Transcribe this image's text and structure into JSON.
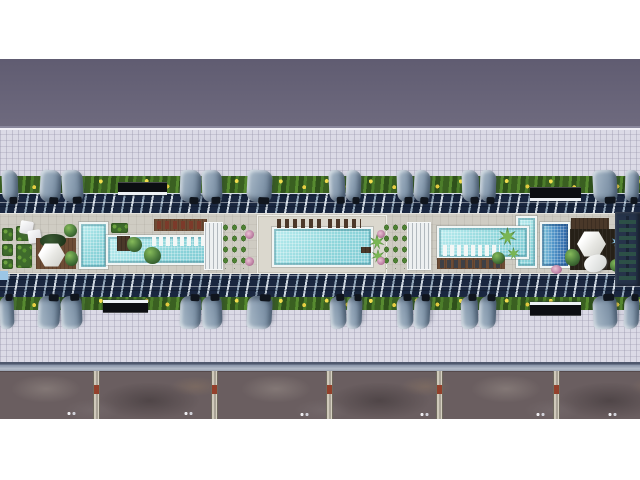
{
  "meta": {
    "kind": "aerial-architectural-render",
    "subject": "top-down 3D rendering of a long residential building rooftop amenity courtyard with three swimming pool zones, landscaping, shade canopies, tiled plazas and a lower service road",
    "visible_text": []
  },
  "palette": {
    "page_margin": "#ffffff",
    "upper_road": "#686479",
    "plaza_tile": "#dbdae6",
    "hedge_green": "#3c6323",
    "flower_yellow": "#f2dd4e",
    "glass_roof_dark": "#1a2740",
    "glass_roof_frame": "#ccd6e0",
    "canopy_steel_blue": "#8da0b3",
    "deck_beige": "#cfccc3",
    "pool_turquoise": "#9fdde1",
    "pool_deep_blue": "#2c62a4",
    "wood_brown": "#6d4c35",
    "rocky_ground": "#6a5e60",
    "divider_concrete": "#cfc9ba",
    "marker_red": "#93402b",
    "facade_navy": "#26334a"
  },
  "scene": {
    "width": 640,
    "height": 480,
    "items": [
      {
        "n": "upper-road-band",
        "c": "band-dark",
        "x": 0,
        "y": 59,
        "w": 640,
        "h": 71
      },
      {
        "n": "plaza-top",
        "c": "plaza edge-top",
        "x": 0,
        "y": 130,
        "w": 640,
        "h": 47
      },
      {
        "n": "plaza-bottom",
        "c": "plaza",
        "x": 0,
        "y": 308,
        "w": 640,
        "h": 55
      },
      {
        "n": "curb-strip",
        "c": "curb",
        "x": 0,
        "y": 362,
        "w": 640,
        "h": 9
      },
      {
        "n": "service-road-rocky",
        "c": "rocky",
        "x": 0,
        "y": 371,
        "w": 640,
        "h": 48
      },
      {
        "n": "hedge-strip-top",
        "c": "hedge",
        "x": 0,
        "y": 176,
        "w": 640,
        "h": 18
      },
      {
        "n": "glass-roof-top",
        "c": "glass",
        "x": 0,
        "y": 193,
        "w": 640,
        "h": 22
      },
      {
        "n": "glass-roof-bottom",
        "c": "glass",
        "x": 0,
        "y": 273,
        "w": 640,
        "h": 26
      },
      {
        "n": "hedge-strip-bottom",
        "c": "hedge",
        "x": 0,
        "y": 297,
        "w": 640,
        "h": 13
      },
      {
        "n": "amenity-deck",
        "c": "deck",
        "x": 0,
        "y": 213,
        "w": 640,
        "h": 61
      },
      {
        "n": "road-divider-1",
        "c": "divider",
        "x": 93,
        "y": 371,
        "w": 7,
        "h": 48
      },
      {
        "n": "road-divider-2",
        "c": "divider",
        "x": 211,
        "y": 371,
        "w": 7,
        "h": 48
      },
      {
        "n": "road-divider-3",
        "c": "divider",
        "x": 326,
        "y": 371,
        "w": 7,
        "h": 48
      },
      {
        "n": "road-divider-4",
        "c": "divider",
        "x": 436,
        "y": 371,
        "w": 7,
        "h": 48
      },
      {
        "n": "road-divider-5",
        "c": "divider",
        "x": 553,
        "y": 371,
        "w": 7,
        "h": 48
      },
      {
        "n": "road-dots-1",
        "c": "dots",
        "x": 66,
        "y": 411,
        "w": 10,
        "h": 5
      },
      {
        "n": "road-dots-2",
        "c": "dots",
        "x": 183,
        "y": 411,
        "w": 10,
        "h": 5
      },
      {
        "n": "road-dots-3",
        "c": "dots",
        "x": 299,
        "y": 412,
        "w": 10,
        "h": 5
      },
      {
        "n": "road-dots-4",
        "c": "dots",
        "x": 419,
        "y": 412,
        "w": 10,
        "h": 5
      },
      {
        "n": "road-dots-5",
        "c": "dots",
        "x": 535,
        "y": 412,
        "w": 10,
        "h": 5
      },
      {
        "n": "road-dots-6",
        "c": "dots",
        "x": 607,
        "y": 412,
        "w": 10,
        "h": 5
      },
      {
        "n": "entry-canopy-top-1",
        "c": "ebar",
        "x": 118,
        "y": 182,
        "w": 49,
        "h": 13
      },
      {
        "n": "entry-canopy-top-2",
        "c": "ebar",
        "x": 530,
        "y": 187,
        "w": 51,
        "h": 14
      },
      {
        "n": "entry-canopy-bottom-1",
        "c": "ebar flip",
        "x": 103,
        "y": 300,
        "w": 45,
        "h": 13
      },
      {
        "n": "entry-canopy-bottom-2",
        "c": "ebar flip",
        "x": 530,
        "y": 302,
        "w": 51,
        "h": 14
      },
      {
        "n": "canopy-top-1",
        "c": "canopy",
        "x": 2,
        "y": 170,
        "w": 16,
        "h": 32,
        "r": -2
      },
      {
        "n": "canopy-top-2",
        "c": "canopy",
        "x": 40,
        "y": 170,
        "w": 21,
        "h": 32,
        "r": 3
      },
      {
        "n": "canopy-top-3",
        "c": "canopy",
        "x": 62,
        "y": 170,
        "w": 21,
        "h": 32,
        "r": -3
      },
      {
        "n": "canopy-top-4",
        "c": "canopy",
        "x": 180,
        "y": 170,
        "w": 21,
        "h": 32,
        "r": 2
      },
      {
        "n": "canopy-top-5",
        "c": "canopy",
        "x": 202,
        "y": 170,
        "w": 20,
        "h": 32,
        "r": -2
      },
      {
        "n": "canopy-top-6",
        "c": "canopy",
        "x": 247,
        "y": 170,
        "w": 25,
        "h": 32,
        "r": 3
      },
      {
        "n": "canopy-top-7",
        "c": "canopy",
        "x": 329,
        "y": 170,
        "w": 16,
        "h": 32,
        "r": -3
      },
      {
        "n": "canopy-top-8",
        "c": "canopy",
        "x": 346,
        "y": 170,
        "w": 15,
        "h": 32,
        "r": 2
      },
      {
        "n": "canopy-top-9",
        "c": "canopy",
        "x": 397,
        "y": 170,
        "w": 16,
        "h": 32,
        "r": -2
      },
      {
        "n": "canopy-top-10",
        "c": "canopy",
        "x": 414,
        "y": 170,
        "w": 16,
        "h": 32,
        "r": 3
      },
      {
        "n": "canopy-top-11",
        "c": "canopy",
        "x": 462,
        "y": 170,
        "w": 17,
        "h": 32,
        "r": -2
      },
      {
        "n": "canopy-top-12",
        "c": "canopy",
        "x": 480,
        "y": 170,
        "w": 16,
        "h": 32,
        "r": 2
      },
      {
        "n": "canopy-top-13",
        "c": "canopy",
        "x": 593,
        "y": 170,
        "w": 24,
        "h": 32,
        "r": -3
      },
      {
        "n": "canopy-top-14",
        "c": "canopy",
        "x": 625,
        "y": 170,
        "w": 14,
        "h": 32,
        "r": 2
      },
      {
        "n": "canopy-bottom-1",
        "c": "canopy flip",
        "x": 0,
        "y": 296,
        "w": 14,
        "h": 33,
        "r": 2
      },
      {
        "n": "canopy-bottom-2",
        "c": "canopy flip",
        "x": 38,
        "y": 296,
        "w": 22,
        "h": 33,
        "r": -3
      },
      {
        "n": "canopy-bottom-3",
        "c": "canopy flip",
        "x": 61,
        "y": 296,
        "w": 21,
        "h": 33,
        "r": 3
      },
      {
        "n": "canopy-bottom-4",
        "c": "canopy flip",
        "x": 180,
        "y": 296,
        "w": 21,
        "h": 33,
        "r": -2
      },
      {
        "n": "canopy-bottom-5",
        "c": "canopy flip",
        "x": 202,
        "y": 296,
        "w": 20,
        "h": 33,
        "r": 2
      },
      {
        "n": "canopy-bottom-6",
        "c": "canopy flip",
        "x": 247,
        "y": 296,
        "w": 25,
        "h": 33,
        "r": -3
      },
      {
        "n": "canopy-bottom-7",
        "c": "canopy flip",
        "x": 330,
        "y": 296,
        "w": 16,
        "h": 33,
        "r": 3
      },
      {
        "n": "canopy-bottom-8",
        "c": "canopy flip",
        "x": 347,
        "y": 296,
        "w": 15,
        "h": 33,
        "r": -2
      },
      {
        "n": "canopy-bottom-9",
        "c": "canopy flip",
        "x": 397,
        "y": 296,
        "w": 16,
        "h": 33,
        "r": 2
      },
      {
        "n": "canopy-bottom-10",
        "c": "canopy flip",
        "x": 414,
        "y": 296,
        "w": 16,
        "h": 33,
        "r": -3
      },
      {
        "n": "canopy-bottom-11",
        "c": "canopy flip",
        "x": 461,
        "y": 296,
        "w": 17,
        "h": 33,
        "r": 2
      },
      {
        "n": "canopy-bottom-12",
        "c": "canopy flip",
        "x": 479,
        "y": 296,
        "w": 17,
        "h": 33,
        "r": -2
      },
      {
        "n": "canopy-bottom-13",
        "c": "canopy flip",
        "x": 593,
        "y": 296,
        "w": 24,
        "h": 33,
        "r": 3
      },
      {
        "n": "canopy-bottom-14",
        "c": "canopy flip",
        "x": 624,
        "y": 296,
        "w": 15,
        "h": 33,
        "r": -2
      },
      {
        "n": "planter-west-1",
        "c": "hedge-box",
        "x": 2,
        "y": 228,
        "w": 11,
        "h": 13
      },
      {
        "n": "planter-west-2",
        "c": "hedge-box",
        "x": 2,
        "y": 244,
        "w": 11,
        "h": 12
      },
      {
        "n": "planter-west-3",
        "c": "hedge-box",
        "x": 2,
        "y": 259,
        "w": 11,
        "h": 10
      },
      {
        "n": "pool-equipment-box",
        "c": "rect",
        "x": 0,
        "y": 271,
        "w": 8,
        "h": 9,
        "bg": "#9cc6e6"
      },
      {
        "n": "planter-west-4",
        "c": "hedge-box",
        "x": 16,
        "y": 226,
        "w": 16,
        "h": 15
      },
      {
        "n": "planter-west-5",
        "c": "hedge-box",
        "x": 16,
        "y": 244,
        "w": 16,
        "h": 24
      },
      {
        "n": "umbrella-west-1",
        "c": "umbrella",
        "x": 20,
        "y": 221,
        "w": 13,
        "h": 13,
        "r": 10
      },
      {
        "n": "umbrella-west-2",
        "c": "umbrella",
        "x": 28,
        "y": 230,
        "w": 13,
        "h": 13,
        "r": -8
      },
      {
        "n": "wood-deck-west",
        "c": "wood",
        "x": 36,
        "y": 238,
        "w": 40,
        "h": 31
      },
      {
        "n": "shade-tree-west",
        "c": "plant-dark",
        "x": 40,
        "y": 234,
        "w": 26,
        "h": 14
      },
      {
        "n": "pavilion-hexagon-west",
        "c": "hexagon",
        "x": 38,
        "y": 243,
        "w": 27,
        "h": 24
      },
      {
        "n": "shrub-west-1",
        "c": "plant",
        "x": 64,
        "y": 224,
        "w": 13,
        "h": 13
      },
      {
        "n": "shrub-west-2",
        "c": "plant",
        "x": 65,
        "y": 251,
        "w": 13,
        "h": 15
      },
      {
        "n": "pool-west-vertical",
        "c": "pool",
        "x": 79,
        "y": 222,
        "w": 29,
        "h": 47
      },
      {
        "n": "pool-west-main",
        "c": "pool",
        "x": 106,
        "y": 235,
        "w": 105,
        "h": 30
      },
      {
        "n": "planter-pool-west",
        "c": "hedge-box",
        "x": 111,
        "y": 223,
        "w": 17,
        "h": 10
      },
      {
        "n": "wood-box-mid",
        "c": "wood-dark",
        "x": 117,
        "y": 236,
        "w": 13,
        "h": 15
      },
      {
        "n": "shrub-mid-1",
        "c": "plant",
        "x": 127,
        "y": 237,
        "w": 15,
        "h": 15
      },
      {
        "n": "shrub-mid-2",
        "c": "plant",
        "x": 144,
        "y": 247,
        "w": 17,
        "h": 17
      },
      {
        "n": "sunbed-deck-west",
        "c": "wood",
        "x": 154,
        "y": 219,
        "w": 53,
        "h": 12
      },
      {
        "n": "sunbeds-red-west",
        "c": "loungers-red",
        "x": 157,
        "y": 221,
        "w": 48,
        "h": 8
      },
      {
        "n": "inpool-loungers-west",
        "c": "loungers-white",
        "x": 152,
        "y": 236,
        "w": 55,
        "h": 10
      },
      {
        "n": "pergola-center-left",
        "c": "pergola",
        "x": 205,
        "y": 223,
        "w": 17,
        "h": 46
      },
      {
        "n": "hedge-grid-left",
        "c": "hedge-grid",
        "x": 221,
        "y": 222,
        "w": 27,
        "h": 47
      },
      {
        "n": "flower-shrub-1",
        "c": "pink",
        "x": 245,
        "y": 230,
        "w": 9,
        "h": 9
      },
      {
        "n": "flower-shrub-2",
        "c": "pink",
        "x": 245,
        "y": 257,
        "w": 9,
        "h": 9
      },
      {
        "n": "pool-terrace-center",
        "c": "deck-pad",
        "x": 258,
        "y": 216,
        "w": 128,
        "h": 57
      },
      {
        "n": "pool-center",
        "c": "pool",
        "x": 272,
        "y": 227,
        "w": 101,
        "h": 40
      },
      {
        "n": "sunbeds-center-1",
        "c": "loungers-dark",
        "x": 277,
        "y": 219,
        "w": 44,
        "h": 9
      },
      {
        "n": "sunbeds-center-2",
        "c": "loungers-dark",
        "x": 328,
        "y": 219,
        "w": 33,
        "h": 9
      },
      {
        "n": "palm-center-1",
        "c": "palm",
        "x": 369,
        "y": 234,
        "w": 16,
        "h": 16
      },
      {
        "n": "palm-center-2",
        "c": "palm",
        "x": 371,
        "y": 249,
        "w": 14,
        "h": 14
      },
      {
        "n": "bench-center",
        "c": "wood-dark",
        "x": 361,
        "y": 247,
        "w": 10,
        "h": 6
      },
      {
        "n": "hedge-grid-right",
        "c": "hedge-grid",
        "x": 382,
        "y": 222,
        "w": 27,
        "h": 47
      },
      {
        "n": "flower-shrub-3",
        "c": "pink",
        "x": 377,
        "y": 230,
        "w": 8,
        "h": 8
      },
      {
        "n": "flower-shrub-4",
        "c": "pink",
        "x": 377,
        "y": 257,
        "w": 8,
        "h": 8
      },
      {
        "n": "pergola-center-right",
        "c": "pergola",
        "x": 408,
        "y": 223,
        "w": 22,
        "h": 46
      },
      {
        "n": "pool-east-extension",
        "c": "pool",
        "x": 516,
        "y": 216,
        "w": 21,
        "h": 52
      },
      {
        "n": "pool-east-main",
        "c": "pool",
        "x": 437,
        "y": 226,
        "w": 92,
        "h": 33
      },
      {
        "n": "inpool-loungers-east",
        "c": "loungers-white",
        "x": 443,
        "y": 245,
        "w": 57,
        "h": 11
      },
      {
        "n": "sunbed-deck-east",
        "c": "wood",
        "x": 437,
        "y": 258,
        "w": 68,
        "h": 11
      },
      {
        "n": "sunbeds-gray-east",
        "c": "loungers-gray",
        "x": 440,
        "y": 260,
        "w": 63,
        "h": 8
      },
      {
        "n": "palm-east-1",
        "c": "palm",
        "x": 498,
        "y": 227,
        "w": 19,
        "h": 19
      },
      {
        "n": "palm-east-2",
        "c": "palm",
        "x": 507,
        "y": 247,
        "w": 13,
        "h": 13
      },
      {
        "n": "shrub-east-0",
        "c": "plant",
        "x": 492,
        "y": 252,
        "w": 13,
        "h": 12
      },
      {
        "n": "wood-ledge-east",
        "c": "wood-dark",
        "x": 571,
        "y": 218,
        "w": 38,
        "h": 11
      },
      {
        "n": "pool-east-vertical",
        "c": "pool-dark",
        "x": 540,
        "y": 222,
        "w": 30,
        "h": 46
      },
      {
        "n": "dark-deck-east",
        "c": "dark-deck",
        "x": 570,
        "y": 229,
        "w": 49,
        "h": 41
      },
      {
        "n": "pavilion-hexagon-east",
        "c": "hexagon",
        "x": 577,
        "y": 231,
        "w": 29,
        "h": 26
      },
      {
        "n": "sculpture-white-east",
        "c": "white-blob",
        "x": 584,
        "y": 255,
        "w": 23,
        "h": 17,
        "r": -15
      },
      {
        "n": "shrub-east-1",
        "c": "plant",
        "x": 565,
        "y": 249,
        "w": 15,
        "h": 17
      },
      {
        "n": "shrub-east-2",
        "c": "plant",
        "x": 610,
        "y": 259,
        "w": 15,
        "h": 13
      },
      {
        "n": "palm-blue-east",
        "c": "palm-blue",
        "x": 611,
        "y": 236,
        "w": 11,
        "h": 11
      },
      {
        "n": "flower-shrub-5",
        "c": "pink",
        "x": 551,
        "y": 265,
        "w": 11,
        "h": 9
      },
      {
        "n": "tower-facade-east",
        "c": "glass-bldg",
        "x": 615,
        "y": 212,
        "w": 25,
        "h": 74
      }
    ]
  }
}
